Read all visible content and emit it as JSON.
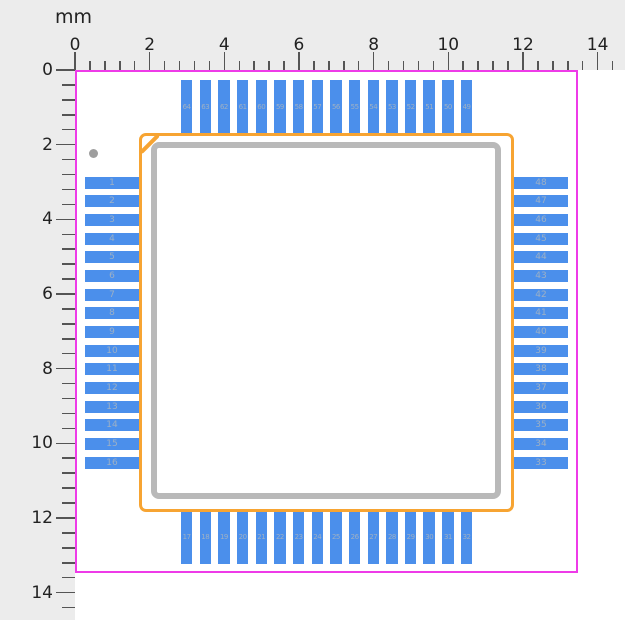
{
  "unit": "mm",
  "ruler": {
    "x_labels": [
      "0",
      "2",
      "4",
      "6",
      "8",
      "10",
      "12",
      "14"
    ],
    "y_labels": [
      "0",
      "2",
      "4",
      "6",
      "8",
      "10",
      "12",
      "14"
    ]
  },
  "pads": {
    "left": [
      "1",
      "2",
      "3",
      "4",
      "5",
      "6",
      "7",
      "8",
      "9",
      "10",
      "11",
      "12",
      "13",
      "14",
      "15",
      "16"
    ],
    "right": [
      "48",
      "47",
      "46",
      "45",
      "44",
      "43",
      "42",
      "41",
      "40",
      "39",
      "38",
      "37",
      "36",
      "35",
      "34",
      "33"
    ],
    "top": [
      "64",
      "63",
      "62",
      "61",
      "60",
      "59",
      "58",
      "57",
      "56",
      "55",
      "54",
      "53",
      "52",
      "51",
      "50",
      "49"
    ],
    "bottom": [
      "17",
      "18",
      "19",
      "20",
      "21",
      "22",
      "23",
      "24",
      "25",
      "26",
      "27",
      "28",
      "29",
      "30",
      "31",
      "32"
    ]
  },
  "colors": {
    "pad": "#4b8feb",
    "pad_number": "#9db0c5",
    "courtyard": "#ee3be8",
    "assembly": "#f7a432",
    "silkscreen": "#b9b9b9",
    "pin1_marker": "#9e9e9e",
    "ruler_background": "#ececec",
    "ruler_text": "#222222",
    "tick": "#555555"
  }
}
